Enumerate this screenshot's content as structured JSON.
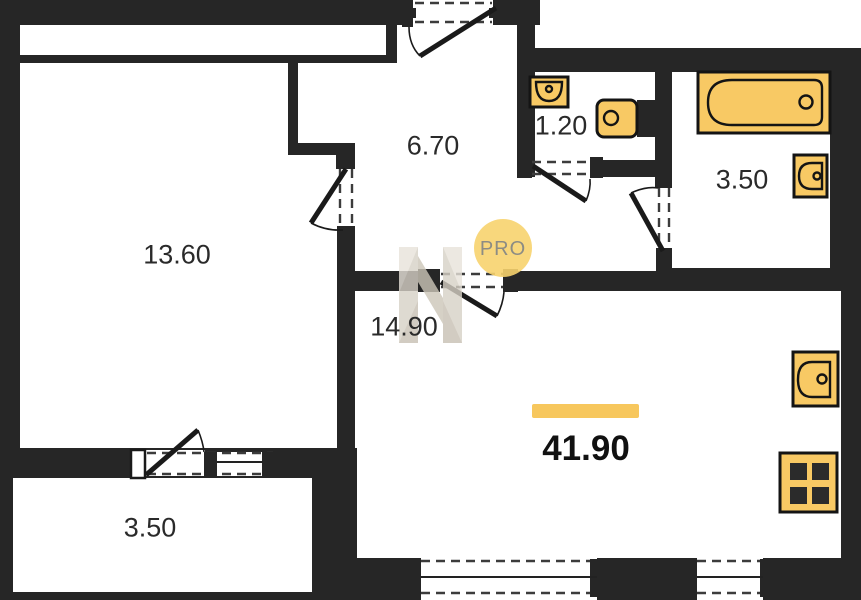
{
  "plan": {
    "total_area": "41.90",
    "rooms": [
      {
        "key": "bedroom",
        "area": "13.60"
      },
      {
        "key": "hall",
        "area": "6.70"
      },
      {
        "key": "wc",
        "area": "1.20"
      },
      {
        "key": "bathroom",
        "area": "3.50"
      },
      {
        "key": "kitchen-living",
        "area": "14.90"
      },
      {
        "key": "balcony",
        "area": "3.50"
      }
    ],
    "watermark": {
      "badge_text": "PRO"
    },
    "fixtures": [
      "bathtub",
      "bathroom-sink",
      "wc-sink",
      "toilet",
      "kitchen-sink",
      "stove"
    ],
    "colors": {
      "wall": "#262626",
      "fixture_fill": "#F8C964",
      "fixture_stroke": "#141414",
      "highlight_bar": "#F7C75D",
      "badge_bg": "#F7D36E",
      "badge_text": "#8C8C84",
      "watermark_bar": "#D7D1C6"
    }
  }
}
